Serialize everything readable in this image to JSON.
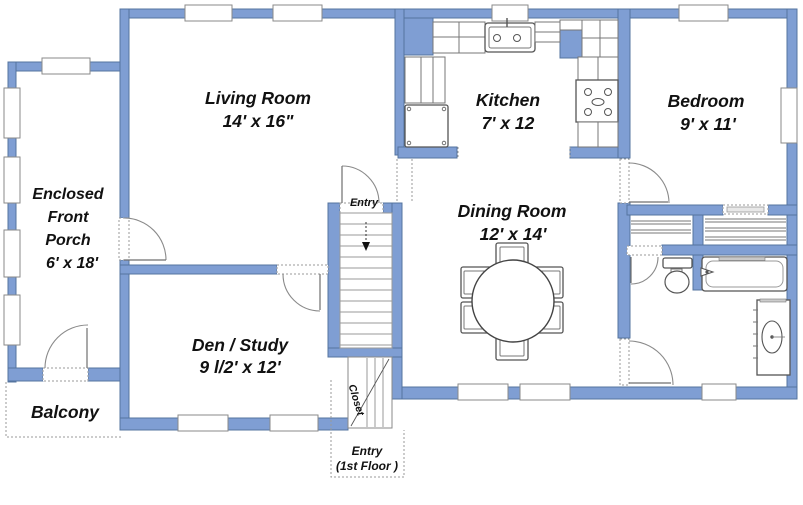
{
  "meta": {
    "type": "floor-plan",
    "wall_fill": "#7f9ed3",
    "wall_stroke": "#54749f",
    "background": "#ffffff"
  },
  "rooms": {
    "living_room": {
      "name": "Living Room",
      "dims": "14' x 16\""
    },
    "kitchen": {
      "name": "Kitchen",
      "dims": "7' x 12"
    },
    "bedroom": {
      "name": "Bedroom",
      "dims": "9' x 11'"
    },
    "dining_room": {
      "name": "Dining Room",
      "dims": "12' x 14'"
    },
    "den": {
      "name": "Den / Study",
      "dims": "9 l/2' x 12'"
    },
    "porch": {
      "name_lines": [
        "Enclosed",
        "Front",
        "Porch"
      ],
      "dims": "6' x 18'"
    },
    "balcony": {
      "name": "Balcony"
    }
  },
  "labels": {
    "entry_upper": "Entry",
    "closet": "Closet",
    "entry_lower_line1": "Entry",
    "entry_lower_line2": "(1st Floor )"
  }
}
